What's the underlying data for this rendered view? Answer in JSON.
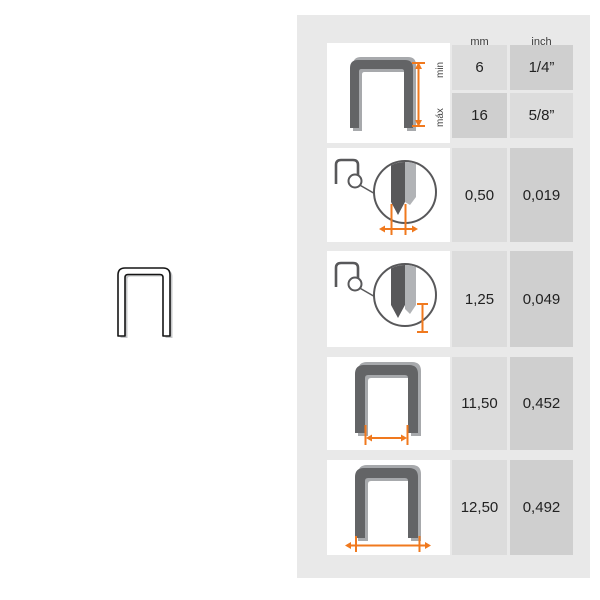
{
  "panel": {
    "header": {
      "mm": "mm",
      "inch": "inch"
    }
  },
  "rows": {
    "leg_length_range": {
      "illustration": "staple-leg-length-dimension-icon",
      "min_label": "min",
      "max_label": "máx",
      "min": {
        "mm": "6",
        "inch": "1/4”"
      },
      "max": {
        "mm": "16",
        "inch": "5/8”"
      }
    },
    "wire_thickness": {
      "illustration": "magnified-staple-point-thickness-icon",
      "mm": "0,50",
      "inch": "0,019"
    },
    "point_length": {
      "illustration": "magnified-staple-point-length-icon",
      "mm": "1,25",
      "inch": "0,049"
    },
    "inner_width": {
      "illustration": "staple-inner-width-dimension-icon",
      "mm": "11,50",
      "inch": "0,452"
    },
    "outer_width": {
      "illustration": "staple-outer-width-dimension-icon",
      "mm": "12,50",
      "inch": "0,492"
    }
  },
  "left_figure": {
    "illustration": "actual-size-staple-outline-icon"
  },
  "colors": {
    "accent_orange": "#f0791e",
    "panel_bg": "#e9e9e9",
    "cell_light": "#dcdcdc",
    "cell_dark": "#cfcfcf",
    "staple_dark": "#636466",
    "staple_light": "#a7a9ac",
    "outline_dark": "#58585a"
  }
}
